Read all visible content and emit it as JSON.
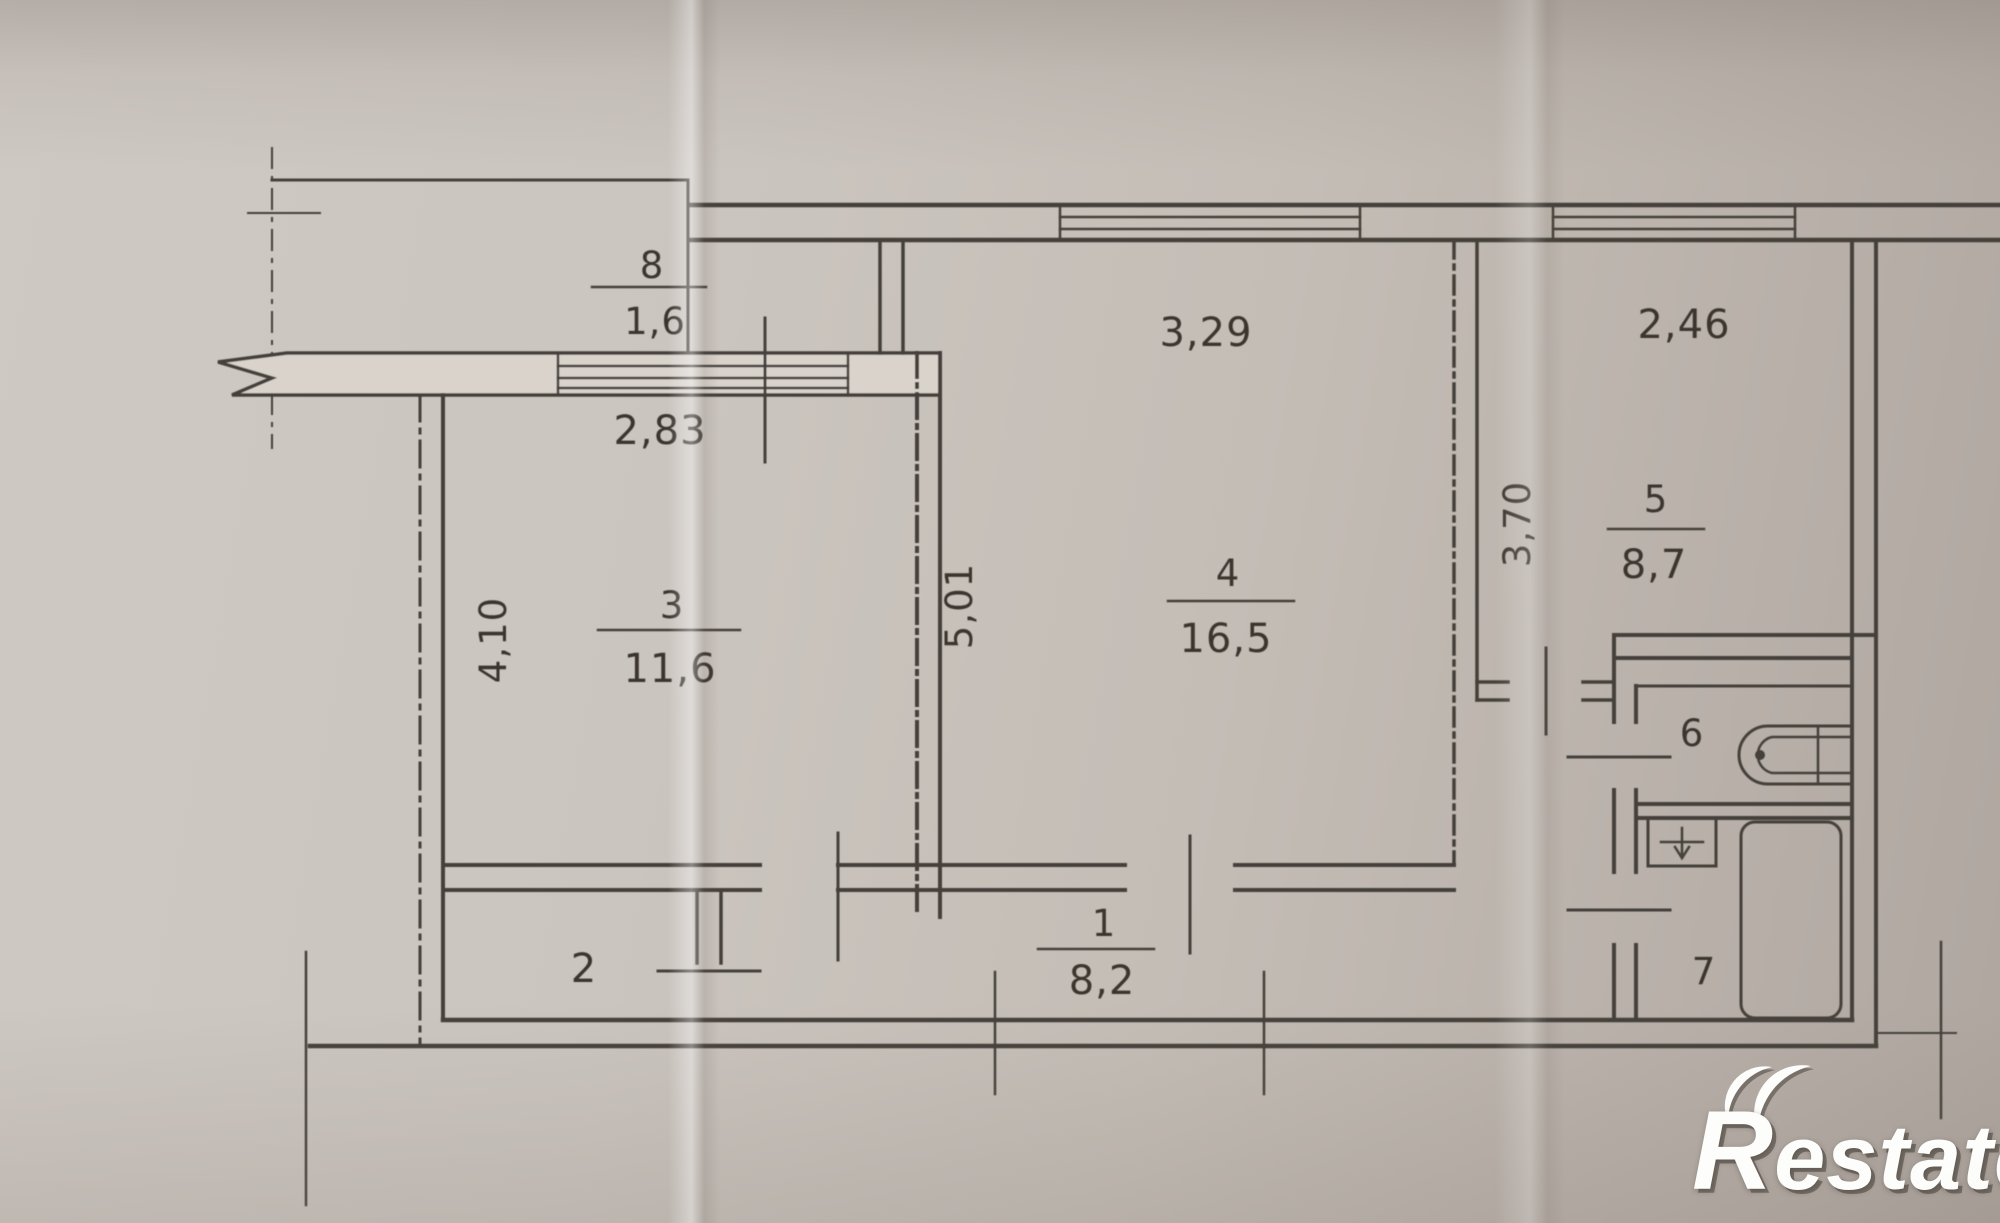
{
  "brand": {
    "text": "Restate",
    "color": "#ffffff"
  },
  "palette": {
    "ink": "#453f38",
    "paper": "#c8c1ba"
  },
  "plan": {
    "rooms": {
      "r1": {
        "number": "1",
        "area": "8,2"
      },
      "r2": {
        "number": "2"
      },
      "r3": {
        "number": "3",
        "area": "11,6"
      },
      "r4": {
        "number": "4",
        "area": "16,5"
      },
      "r5": {
        "number": "5",
        "area": "8,7"
      },
      "r6": {
        "number": "6"
      },
      "r7": {
        "number": "7"
      },
      "r8": {
        "number": "8",
        "area": "1,6"
      }
    },
    "dimensions": {
      "balcony_window_width": "2,83",
      "room4_window_width": "3,29",
      "room5_window_width": "2,46",
      "room3_depth": "4,10",
      "room4_depth": "5,01",
      "room5_depth": "3,70"
    }
  }
}
